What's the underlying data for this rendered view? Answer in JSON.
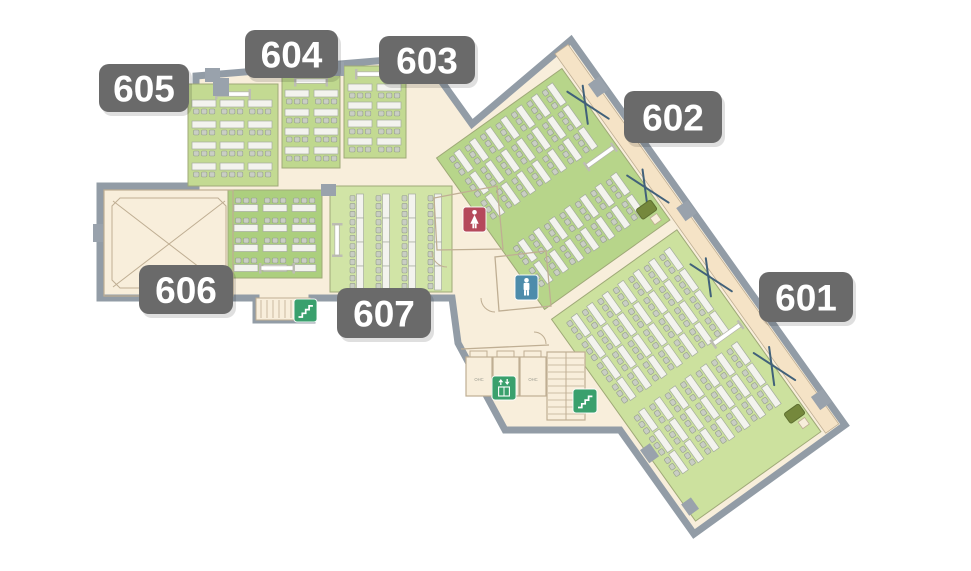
{
  "title": "Floor plan – rooms 601–607",
  "colors": {
    "outside": "#ffffff",
    "cream": "#f8eedb",
    "balcony": "#f5e3c6",
    "wall": "#929ca6",
    "thin_wall": "#bfae93",
    "room_line": "#9fa978",
    "table_fill": "#f3f3ee",
    "table_line": "#a5ad9f",
    "chair_fill": "#c9cec3",
    "chair_line": "#969e91",
    "column": "#99a2ac",
    "screen_bar": "#ffffff",
    "screen_line": "#b6b6ac",
    "screen_cap": "#bdbdb3",
    "podium": "#75883c",
    "podium_line": "#5e7030",
    "x_mark": "#41617a",
    "badge": "#6a6a6a",
    "badge_text": "#ffffff",
    "shadow": "rgba(0,0,0,0.28)",
    "ohc_text": "#9b9b90",
    "icon_green": "#3aa06d",
    "icon_red": "#b5495b",
    "icon_blue": "#4d8cab"
  },
  "outline": [
    [
      196,
      76
    ],
    [
      424,
      57
    ],
    [
      472,
      124
    ],
    [
      571,
      40
    ],
    [
      845,
      425
    ],
    [
      694,
      534
    ],
    [
      620,
      430
    ],
    [
      505,
      430
    ],
    [
      458,
      343
    ],
    [
      452,
      298
    ],
    [
      312,
      298
    ],
    [
      312,
      320
    ],
    [
      256,
      320
    ],
    [
      256,
      298
    ],
    [
      100,
      298
    ],
    [
      100,
      186
    ],
    [
      196,
      186
    ]
  ],
  "wing": {
    "translate": [
      571,
      40
    ],
    "rotate": 54.5,
    "balcony": [
      2,
      5,
      466,
      16
    ],
    "rooms": [
      {
        "id": "602",
        "rect": [
          18,
          24,
          186,
          154
        ],
        "color": "#b7d58a",
        "desks": {
          "type": "h-below",
          "xs": [
            24,
            51,
            78,
            134,
            161
          ],
          "ys": [
            40,
            59,
            78,
            97,
            116,
            135,
            154
          ]
        },
        "screen": {
          "x": 112,
          "y": 28,
          "len": 32,
          "dir": "v"
        },
        "podium": [
          176,
          28
        ],
        "cream_box": [
          191,
          31
        ],
        "x_marks": [
          [
            63,
            24
          ],
          [
            166,
            24
          ]
        ]
      },
      {
        "id": "601",
        "rect": [
          216,
          24,
          248,
          154
        ],
        "color": "#cce19e",
        "desks": {
          "type": "h-below",
          "xs": [
            226,
            252,
            278,
            304,
            342,
            368,
            394
          ],
          "ys": [
            40,
            59,
            78,
            97,
            116,
            135,
            154
          ]
        },
        "screen": {
          "x": 330,
          "y": 28,
          "len": 32,
          "dir": "v"
        },
        "podium": [
          428,
          26
        ],
        "cream_box": [
          443,
          29
        ],
        "x_marks": [
          [
            275,
            24
          ],
          [
            384,
            24
          ]
        ]
      }
    ],
    "columns": [
      [
        46,
        -2,
        16,
        14
      ],
      [
        198,
        -2,
        16,
        14
      ],
      [
        430,
        -2,
        16,
        14
      ],
      [
        374,
        170,
        16,
        12
      ],
      [
        442,
        168,
        14,
        12
      ]
    ]
  },
  "left_rooms": [
    {
      "id": "605",
      "rect": [
        188,
        84,
        90,
        102
      ],
      "color": "#c3da92",
      "desks": {
        "type": "h-below",
        "xs": [
          192,
          220,
          248
        ],
        "ys": [
          100,
          121,
          142,
          163
        ]
      },
      "screen": {
        "x": 217,
        "y": 94,
        "len": 32,
        "dir": "h"
      }
    },
    {
      "id": "604",
      "rect": [
        282,
        72,
        58,
        96
      ],
      "color": "#bfd88e",
      "desks": {
        "type": "h-below",
        "xs": [
          285,
          314
        ],
        "ys": [
          90,
          109,
          128,
          147
        ]
      },
      "screen": {
        "x": 296,
        "y": 81,
        "len": 30,
        "dir": "h"
      }
    },
    {
      "id": "603",
      "rect": [
        344,
        66,
        62,
        92
      ],
      "color": "#c3da92",
      "desks": {
        "type": "h-below",
        "xs": [
          348,
          377
        ],
        "ys": [
          84,
          102,
          120,
          138
        ]
      },
      "screen": {
        "x": 357,
        "y": 74,
        "len": 30,
        "dir": "h"
      }
    },
    {
      "id": "606",
      "rect": [
        228,
        190,
        94,
        88
      ],
      "color": "#accf7e",
      "desks": {
        "type": "h-above",
        "xs": [
          234,
          263,
          292
        ],
        "ys": [
          198,
          218,
          238,
          258
        ]
      },
      "screen": {
        "x": 261,
        "y": 268,
        "len": 32,
        "dir": "h"
      }
    },
    {
      "id": "607",
      "rect": [
        330,
        186,
        122,
        106
      ],
      "color": "#d1e4a6",
      "desks": {
        "type": "v-left",
        "xs": [
          350,
          376,
          402,
          428
        ],
        "ys": [
          194,
          218,
          242,
          266
        ]
      },
      "screen": {
        "x": 337,
        "y": 225,
        "len": 30,
        "dir": "v"
      }
    }
  ],
  "void_room": {
    "outer": [
      104,
      190,
      129,
      106
    ],
    "bevel": "M120,198 H218 L226,206 V280 L218,288 H120 L112,280 V206 Z",
    "x1": [
      113,
      201,
      225,
      287
    ],
    "x2": [
      225,
      201,
      113,
      287
    ]
  },
  "lobby": {
    "walls": [
      "M437,250 L434,198 L497,186 L503,249 Z",
      "M499,311 L495,257 L546,251 L551,306 Z",
      "M461,349 L549,345"
    ],
    "arcs": [
      "M447,267 A15,15 0 0 1 432,252",
      "M495,312 A14,14 0 0 1 481,298",
      "M546,344 A12,12 0 0 0 534,332"
    ],
    "shafts": [
      [
        466,
        357,
        26,
        39
      ],
      [
        493,
        357,
        26,
        39
      ],
      [
        520,
        357,
        26,
        39
      ]
    ],
    "shaft_doors": [
      [
        470,
        351,
        17,
        6
      ],
      [
        497,
        351,
        17,
        6
      ],
      [
        524,
        351,
        17,
        6
      ]
    ],
    "shaft_labels": [
      {
        "text": "OHC",
        "x": 479,
        "y": 381
      },
      {
        "text": "OHC",
        "x": 533,
        "y": 381
      }
    ],
    "stairs_main": {
      "rect": [
        547,
        352,
        38,
        68
      ],
      "treads_y": [
        358,
        365,
        372,
        379,
        386,
        393,
        400,
        407,
        414
      ],
      "center_x": 566
    },
    "stairs_small": {
      "rect": [
        256,
        298,
        54,
        22
      ],
      "treads_x": [
        261,
        267,
        273,
        279,
        285,
        291,
        297,
        303
      ],
      "tread_y1": 300,
      "tread_y2": 318
    }
  },
  "columns": [
    [
      205,
      68,
      15,
      14
    ],
    [
      329,
      62,
      15,
      14
    ],
    [
      412,
      52,
      14,
      13
    ],
    [
      321,
      184,
      15,
      12
    ],
    [
      213,
      78,
      16,
      18
    ],
    [
      93,
      224,
      10,
      18
    ]
  ],
  "badges": [
    {
      "id": "601",
      "label": "601",
      "x": 759,
      "y": 272,
      "w": 94,
      "h": 50
    },
    {
      "id": "602",
      "label": "602",
      "x": 624,
      "y": 91,
      "w": 98,
      "h": 52
    },
    {
      "id": "603",
      "label": "603",
      "x": 379,
      "y": 36,
      "w": 96,
      "h": 48
    },
    {
      "id": "604",
      "label": "604",
      "x": 245,
      "y": 30,
      "w": 93,
      "h": 48
    },
    {
      "id": "605",
      "label": "605",
      "x": 99,
      "y": 64,
      "w": 90,
      "h": 48
    },
    {
      "id": "606",
      "label": "606",
      "x": 139,
      "y": 265,
      "w": 94,
      "h": 49
    },
    {
      "id": "607",
      "label": "607",
      "x": 337,
      "y": 288,
      "w": 94,
      "h": 50
    }
  ],
  "icons": [
    {
      "name": "womens-restroom-icon",
      "type": "woman",
      "x": 463,
      "y": 207,
      "w": 23,
      "h": 25,
      "color": "#b5495b"
    },
    {
      "name": "mens-restroom-icon",
      "type": "man",
      "x": 515,
      "y": 275,
      "w": 23,
      "h": 25,
      "color": "#4d8cab"
    },
    {
      "name": "elevator-icon",
      "type": "elevator",
      "x": 492,
      "y": 376,
      "w": 24,
      "h": 24,
      "color": "#3aa06d"
    },
    {
      "name": "stairs-icon-main",
      "type": "stairs",
      "x": 573,
      "y": 389,
      "w": 24,
      "h": 24,
      "color": "#3aa06d"
    },
    {
      "name": "stairs-icon-west",
      "type": "stairs",
      "x": 294,
      "y": 299,
      "w": 23,
      "h": 23,
      "color": "#3aa06d"
    }
  ]
}
